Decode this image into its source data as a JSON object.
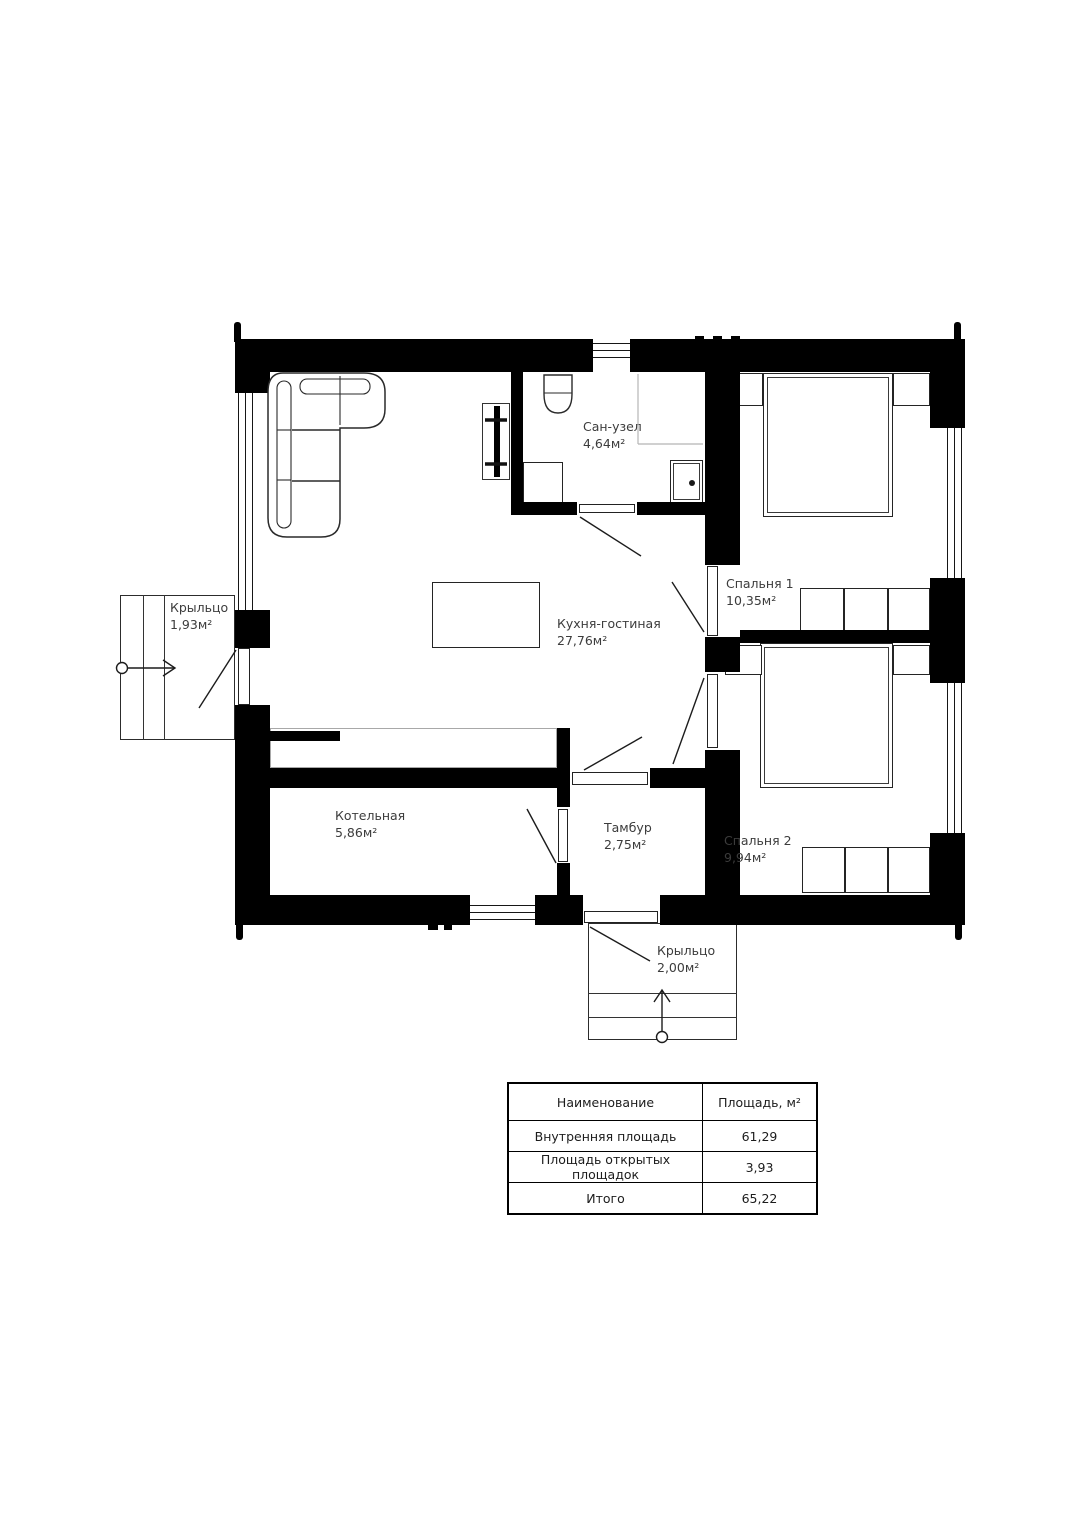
{
  "colors": {
    "wall": "#000000",
    "text": "#3c3c3c",
    "light_line": "#b5b5b5"
  },
  "rooms": [
    {
      "name": "Сан-узел",
      "area": "4,64м²"
    },
    {
      "name": "Спальня 1",
      "area": "10,35м²"
    },
    {
      "name": "Кухня-гостиная",
      "area": "27,76м²"
    },
    {
      "name": "Крыльцо",
      "area": "1,93м²"
    },
    {
      "name": "Котельная",
      "area": "5,86м²"
    },
    {
      "name": "Тамбур",
      "area": "2,75м²"
    },
    {
      "name": "Спальня 2",
      "area": "9,94м²"
    },
    {
      "name": "Крыльцо",
      "area": "2,00м²"
    }
  ],
  "plan_table": {
    "headers": [
      "Наименование",
      "Площадь, м²"
    ],
    "rows": [
      {
        "name": "Внутренняя площадь",
        "value": "61,29"
      },
      {
        "name": "Площадь открытых площадок",
        "value": "3,93"
      },
      {
        "name": "Итого",
        "value": "65,22"
      }
    ]
  }
}
